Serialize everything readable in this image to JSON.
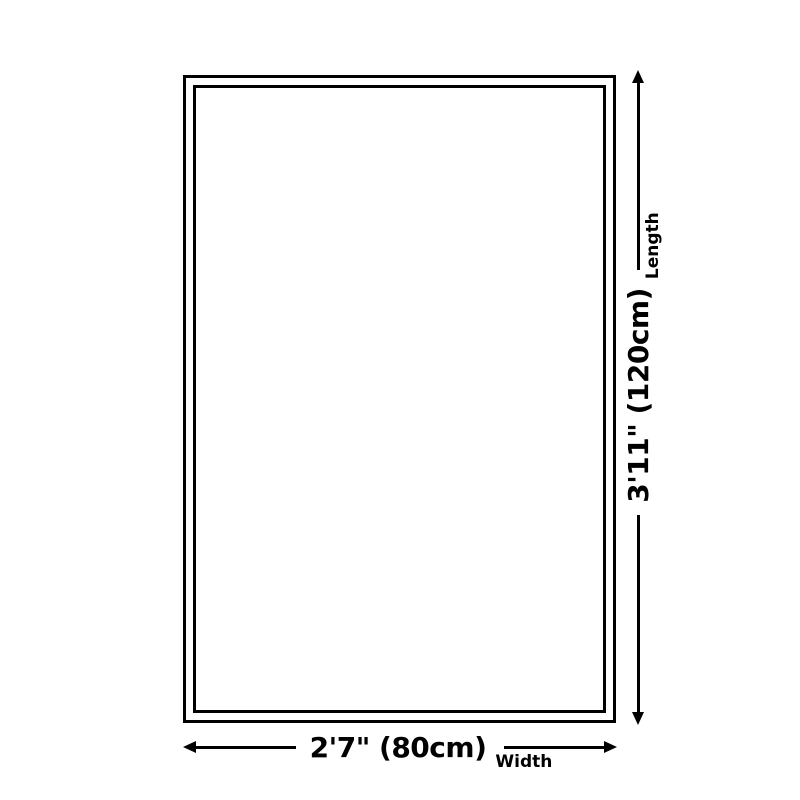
{
  "diagram": {
    "type": "product-size-diagram",
    "colors": {
      "line": "#000000",
      "background": "#ffffff"
    }
  },
  "length": {
    "value": "3'11\" (120cm)",
    "label": "Length"
  },
  "width": {
    "value": "2'7\" (80cm)",
    "label": "Width"
  }
}
